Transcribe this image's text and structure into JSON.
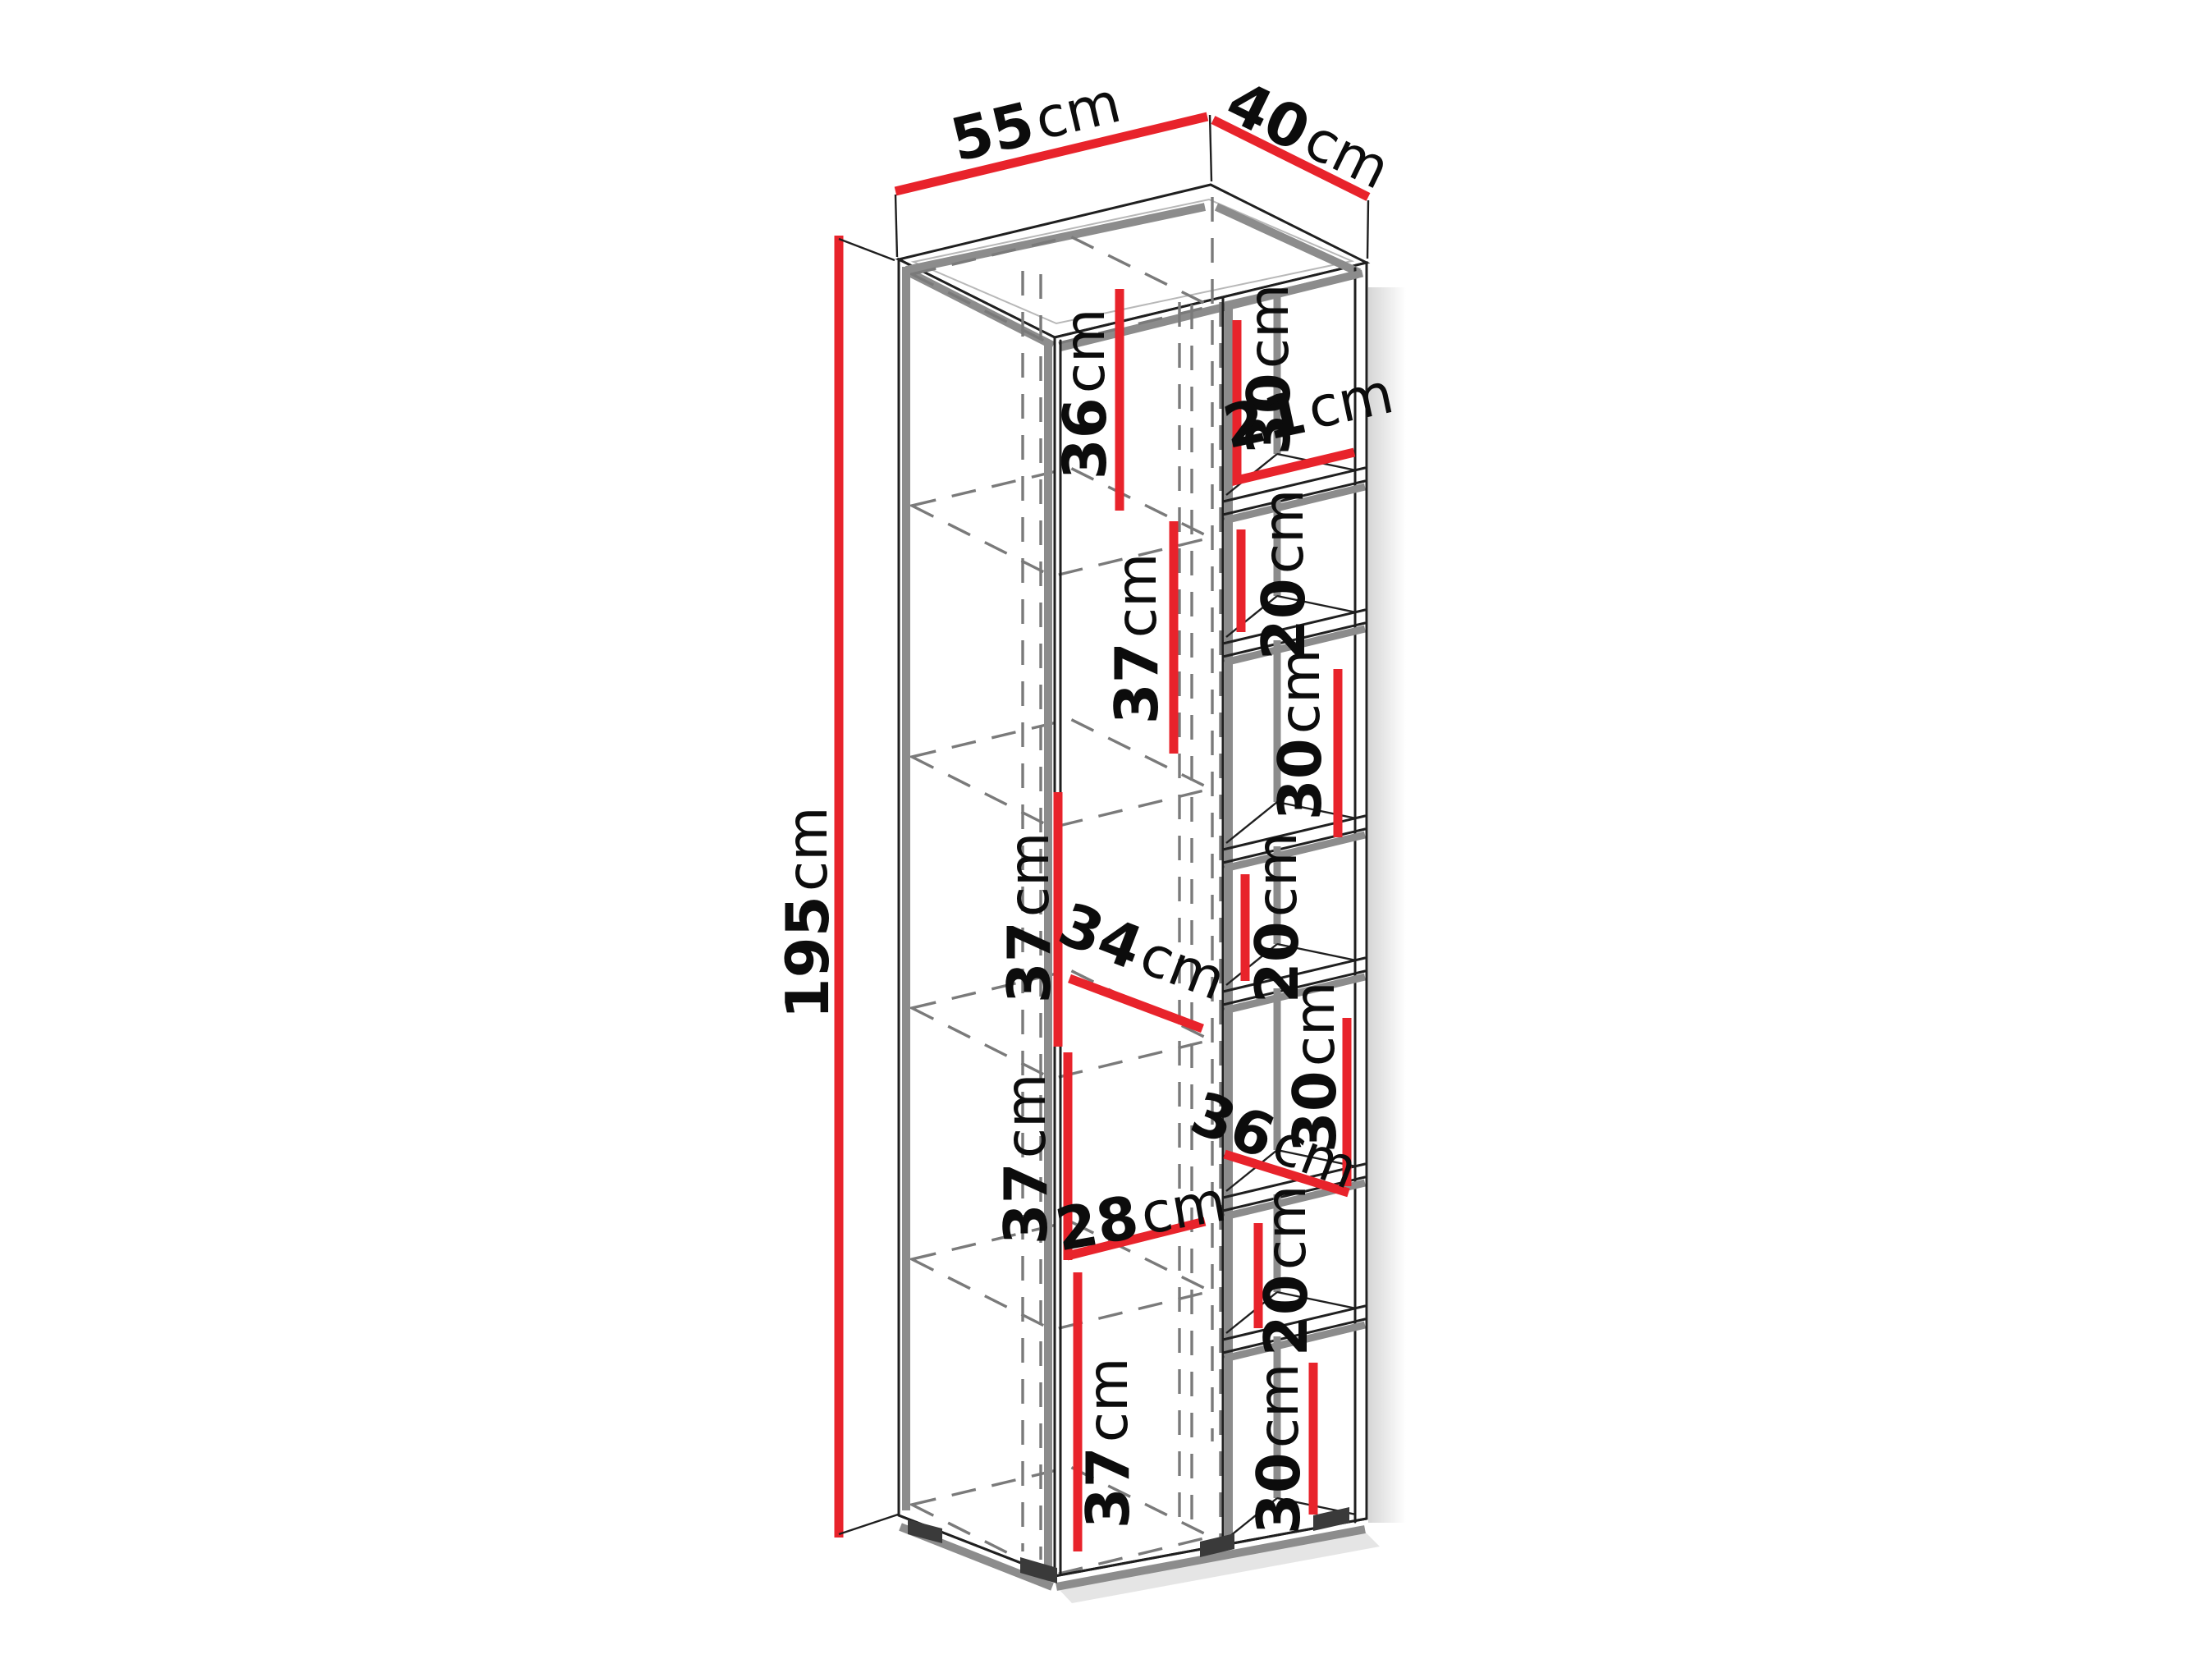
{
  "figure": {
    "kind": "furniture-dimension-diagram",
    "object": "tall bookcase / cabinet in axonometric view",
    "background": "#ffffff"
  },
  "colors": {
    "dimension_line": "#e8232b",
    "structure_gray": "#8c8c8c",
    "edge_black": "#1f1f1f",
    "hidden_dash_gray": "#7a7a7a",
    "text": "#0c0c0c"
  },
  "dims": {
    "overall_width": {
      "value": "55",
      "unit": "cm"
    },
    "overall_depth": {
      "value": "40",
      "unit": "cm"
    },
    "overall_height": {
      "value": "195",
      "unit": "cm"
    },
    "left": {
      "compartments": [
        {
          "value": "36",
          "unit": "cm"
        },
        {
          "value": "37",
          "unit": "cm"
        },
        {
          "value": "37",
          "unit": "cm"
        },
        {
          "value": "37",
          "unit": "cm"
        },
        {
          "value": "37",
          "unit": "cm"
        }
      ],
      "interior_depth": {
        "value": "34",
        "unit": "cm"
      },
      "interior_width": {
        "value": "28",
        "unit": "cm"
      }
    },
    "right": {
      "compartments": [
        {
          "value": "30",
          "unit": "cm"
        },
        {
          "value": "20",
          "unit": "cm"
        },
        {
          "value": "30",
          "unit": "cm"
        },
        {
          "value": "20",
          "unit": "cm"
        },
        {
          "value": "30",
          "unit": "cm"
        },
        {
          "value": "20",
          "unit": "cm"
        },
        {
          "value": "30",
          "unit": "cm"
        }
      ],
      "interior_width": {
        "value": "21",
        "unit": "cm"
      },
      "interior_depth": {
        "value": "36",
        "unit": "cm"
      }
    }
  }
}
